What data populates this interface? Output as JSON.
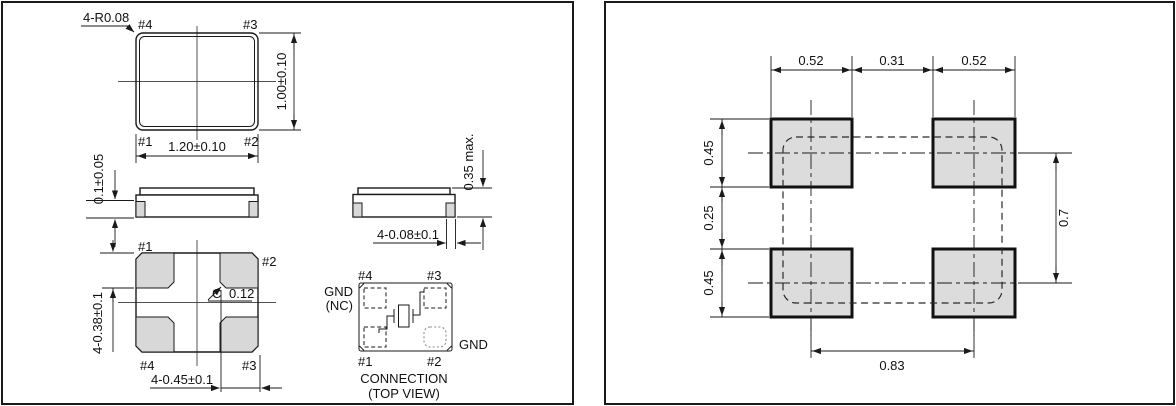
{
  "panels": {
    "package": {
      "top_view": {
        "corner_radius_label": "4-R0.08",
        "pin_tl": "#4",
        "pin_tr": "#3",
        "pin_bl": "#1",
        "pin_br": "#2",
        "width_dim": "1.20±0.10",
        "height_dim": "1.00±0.10"
      },
      "side_view": {
        "terminal_thickness_dim": "0.1±0.05"
      },
      "end_view": {
        "max_height_dim": "0.35 max.",
        "terminal_width_dim": "4-0.08±0.1"
      },
      "bottom_view": {
        "pin_tl": "#1",
        "pin_tr": "#2",
        "pin_bl": "#4",
        "pin_br": "#3",
        "pad_length_dim": "4-0.38±0.1",
        "pad_width_dim": "4-0.45±0.1",
        "chamfer_letter": "C",
        "chamfer_value": "0.12"
      },
      "connection": {
        "pin_tl": "#4",
        "pin_tr": "#3",
        "pin_bl": "#1",
        "pin_br": "#2",
        "label_left_line1": "GND",
        "label_left_line2": "(NC)",
        "label_right": "GND",
        "caption_line1": "CONNECTION",
        "caption_line2": "(TOP VIEW)"
      }
    },
    "land_pattern": {
      "dim_top_left": "0.52",
      "dim_top_center": "0.31",
      "dim_top_right": "0.52",
      "dim_left_top": "0.45",
      "dim_left_middle": "0.25",
      "dim_left_bottom": "0.45",
      "dim_right": "0.7",
      "dim_bottom": "0.83"
    }
  },
  "colors": {
    "line": "#1a1a1a",
    "pad_fill": "#d8d8d8",
    "land_pad_fill": "#dcdcdc",
    "background": "#ffffff"
  }
}
